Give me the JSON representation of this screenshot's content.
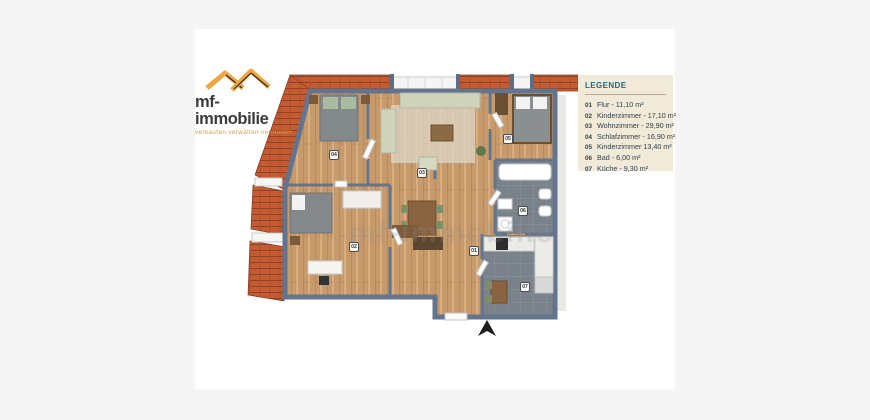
{
  "page": {
    "background_color": "#f4f5f4",
    "panel_color": "#ffffff"
  },
  "logo": {
    "name": "mf-immobilie",
    "tagline": "verkaufen verwalten vermieten",
    "roof_icon_color": "#f0a642",
    "name_color": "#3b3b3b",
    "tagline_color": "#e79a3b"
  },
  "legend": {
    "title": "LEGENDE",
    "title_color": "#1a6a90",
    "box_color": "#f1ead8",
    "text_color": "#32404c",
    "items": [
      {
        "num": "01",
        "label": "Flur - 11,10 m²"
      },
      {
        "num": "02",
        "label": "Kinderzimmer - 17,10 m²"
      },
      {
        "num": "03",
        "label": "Wohnzimmer - 29,90 m²"
      },
      {
        "num": "04",
        "label": "Schlafzimmer - 16,90 m²"
      },
      {
        "num": "05",
        "label": "Kinderzimmer 13,40 m²"
      },
      {
        "num": "06",
        "label": "Bad - 6,00 m²"
      },
      {
        "num": "07",
        "label": "Küche - 9,30 m²"
      }
    ]
  },
  "floorplan": {
    "watermark": "mf-immobilie",
    "wall_color": "#64748c",
    "wood_floor_color": "#c79a6c",
    "tile_floor_color": "#79828a",
    "roof_color": "#c65a31",
    "rooms": [
      {
        "num": "01"
      },
      {
        "num": "02"
      },
      {
        "num": "03"
      },
      {
        "num": "04"
      },
      {
        "num": "05"
      },
      {
        "num": "06"
      },
      {
        "num": "07"
      }
    ]
  }
}
